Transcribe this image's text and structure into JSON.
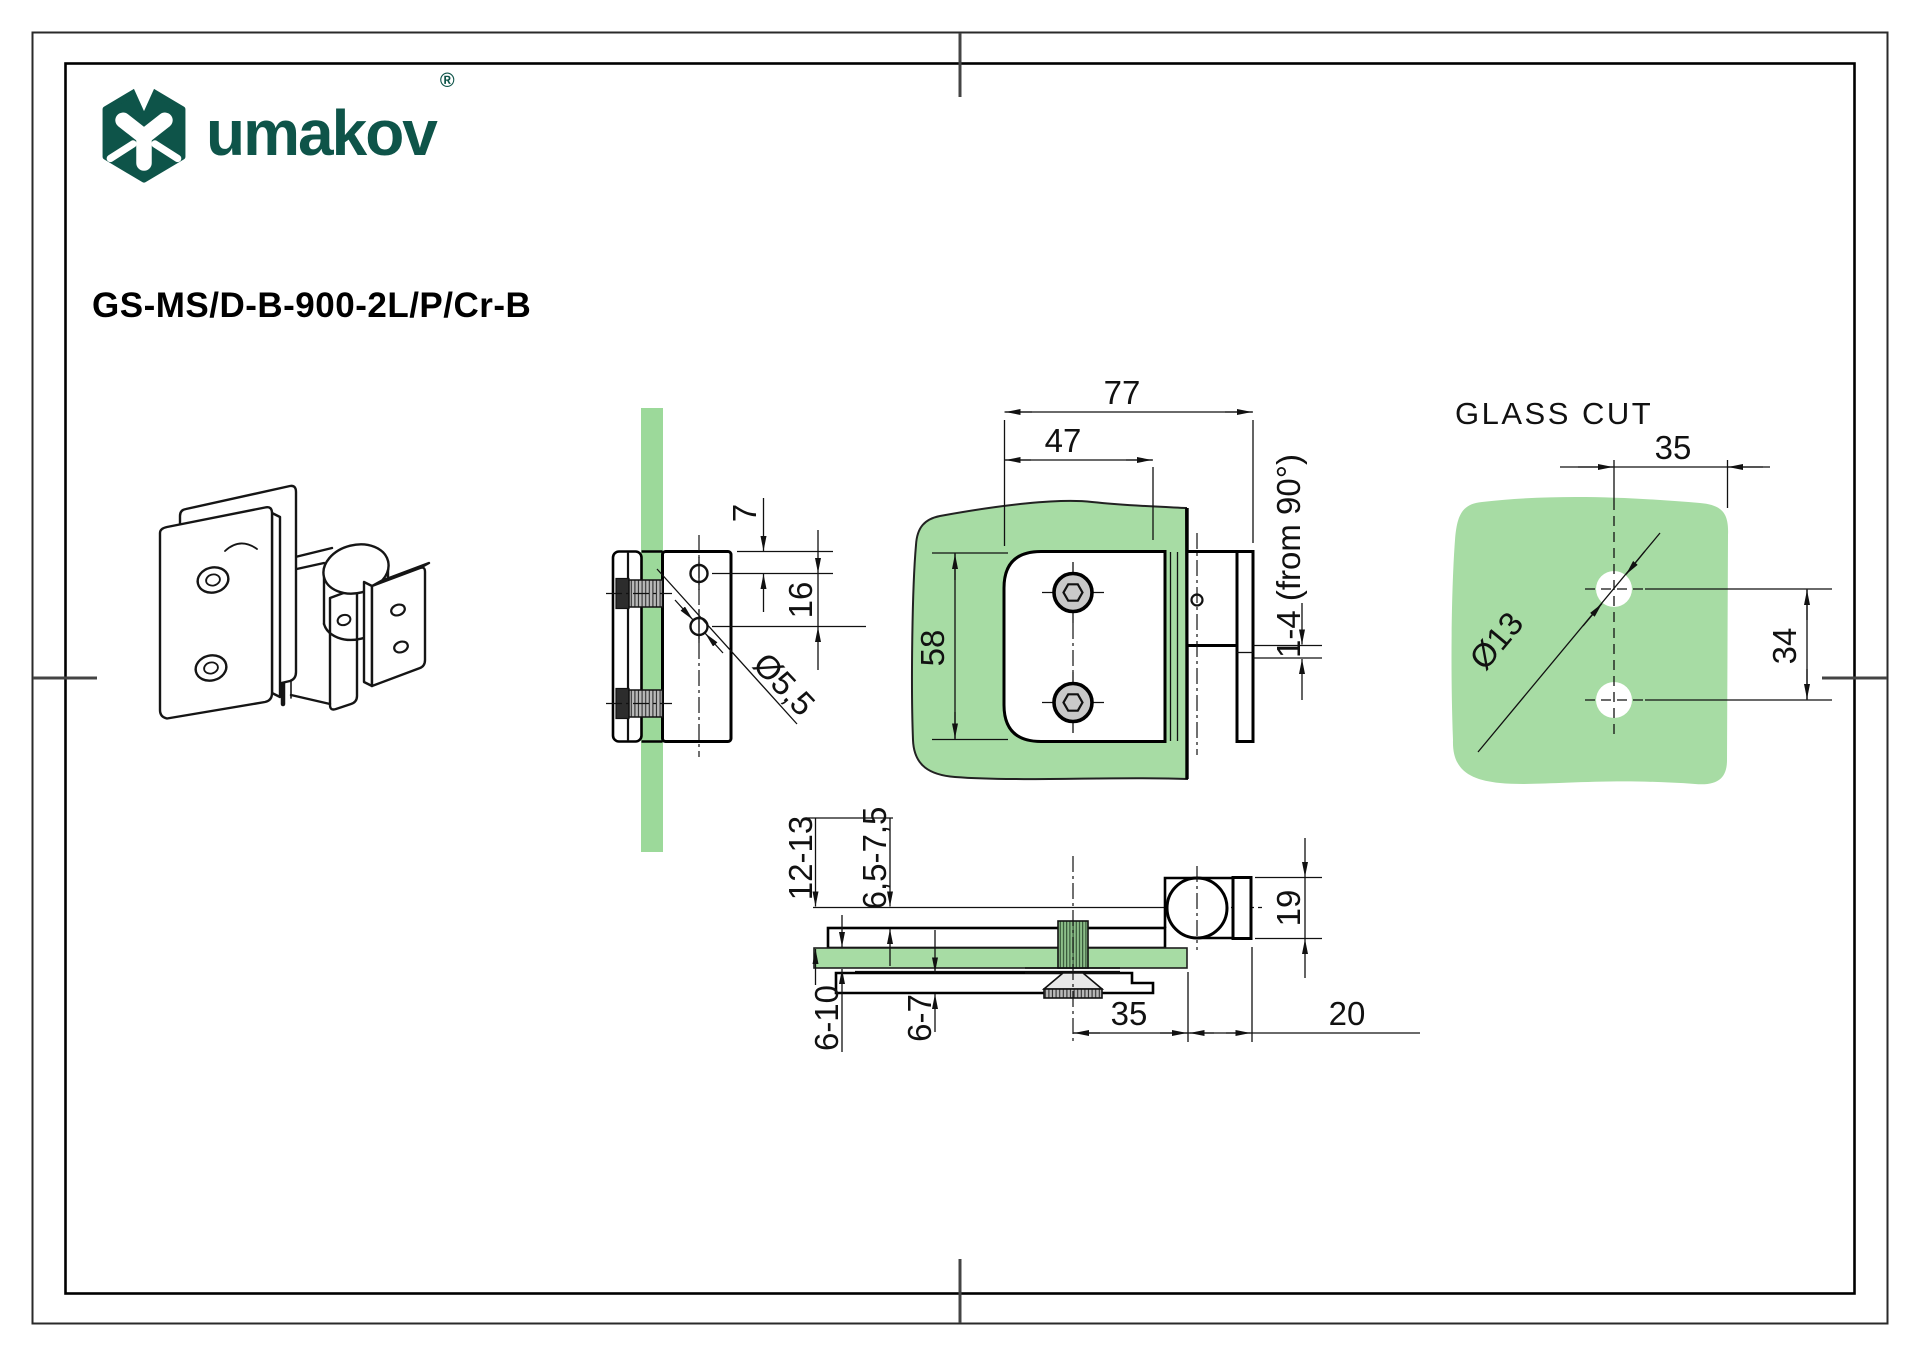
{
  "brand": {
    "name": "umakov",
    "registered": "®"
  },
  "product": {
    "code": "GS-MS/D-B-900-2L/P/Cr-B"
  },
  "colors": {
    "brand_green": "#0e5449",
    "glass_green": "#a7dca4",
    "glass_green_side": "#9cd99a",
    "screw_gray": "#c9c9c9",
    "line_black": "#111111"
  },
  "views": {
    "side_view": {
      "dim_hole_offset_top": "7",
      "dim_hole_spacing": "16",
      "dim_hole_diameter": "Ø5,5"
    },
    "front_view": {
      "dim_total_width": "77",
      "dim_plate_width": "47",
      "dim_plate_height": "58",
      "dim_adjustment": "1-4  (from 90°)"
    },
    "glass_cut": {
      "title": "GLASS CUT",
      "dim_hole_offset_x": "35",
      "dim_hole_diameter": "Ø13",
      "dim_hole_spacing": "34"
    },
    "bottom_view": {
      "dim_pivot_to_glass": "12-13",
      "dim_clamp_range": "6,5-7,5",
      "dim_glass_thickness": "6-10",
      "dim_bottom_gap": "6-7",
      "dim_screw_to_edge": "35",
      "dim_wall_offset": "20",
      "dim_knuckle_height": "19"
    }
  }
}
